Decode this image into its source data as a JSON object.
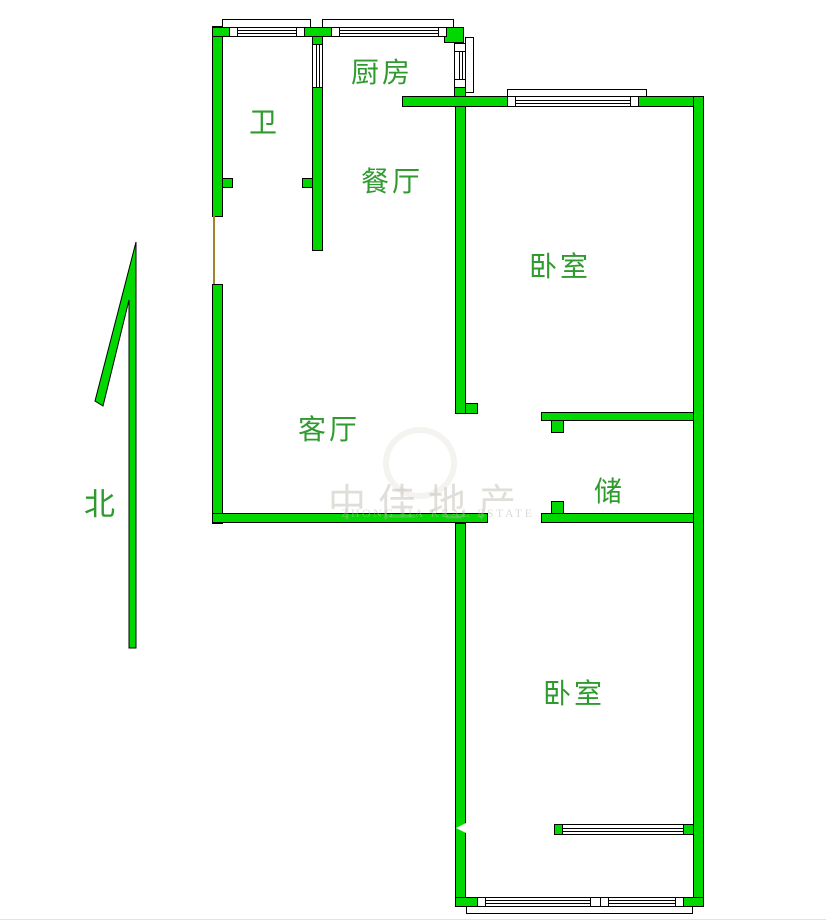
{
  "title": "apartment-floor-plan",
  "colors": {
    "wall_green": "#00D800",
    "label_green": "#2F9B2F",
    "outline_black": "#000000",
    "door_line_olive": "#A1852A"
  },
  "rooms": {
    "bathroom": {
      "label": "卫"
    },
    "kitchen": {
      "label": "厨房"
    },
    "dining": {
      "label": "餐厅"
    },
    "bedroom_top": {
      "label": "卧室"
    },
    "living": {
      "label": "客厅"
    },
    "storage": {
      "label": "储"
    },
    "bedroom_bottom": {
      "label": "卧室"
    }
  },
  "compass": {
    "label": "北"
  },
  "watermark": {
    "cn": "中佳地产",
    "en": "ZHONG JIA REAL ESTATE"
  }
}
